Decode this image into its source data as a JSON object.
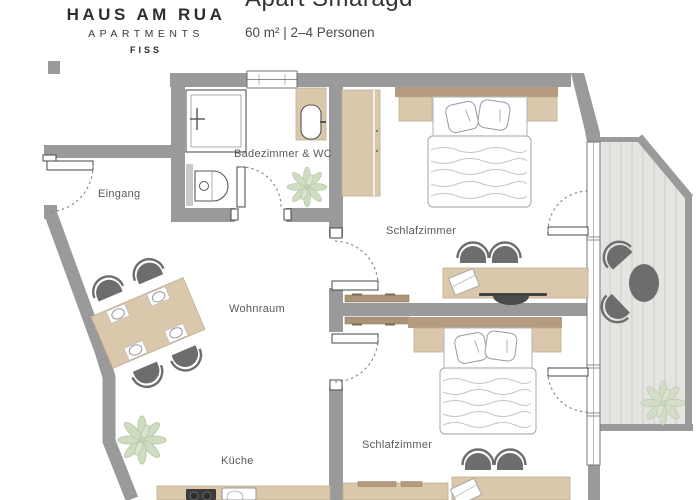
{
  "header": {
    "logo": {
      "line1": "HAUS AM RUA",
      "line2": "APARTMENTS",
      "line3": "FISS"
    },
    "apartment": {
      "title": "Apart Smaragd",
      "subtitle": "60 m² | 2–4 Personen"
    }
  },
  "floorplan": {
    "rooms": {
      "eingang": "Eingang",
      "badezimmer": "Badezimmer & WC",
      "schlafzimmer1": "Schlafzimmer",
      "wohnraum": "Wohnraum",
      "schlafzimmer2": "Schlafzimmer",
      "kueche": "Küche"
    }
  },
  "colors": {
    "wall": "#9a9a9a",
    "furniture": "#d9c8ac",
    "furniture_edge": "#c2ae8e",
    "headboard": "#b59b80",
    "chair": "#6d6d6d",
    "deck": "#e4e4e1",
    "deck_line": "#cfcfcb",
    "plant": "#cfdcc2",
    "plant_edge": "#b4c6a2",
    "text": "#595959",
    "heading": "#2e2e2e"
  }
}
